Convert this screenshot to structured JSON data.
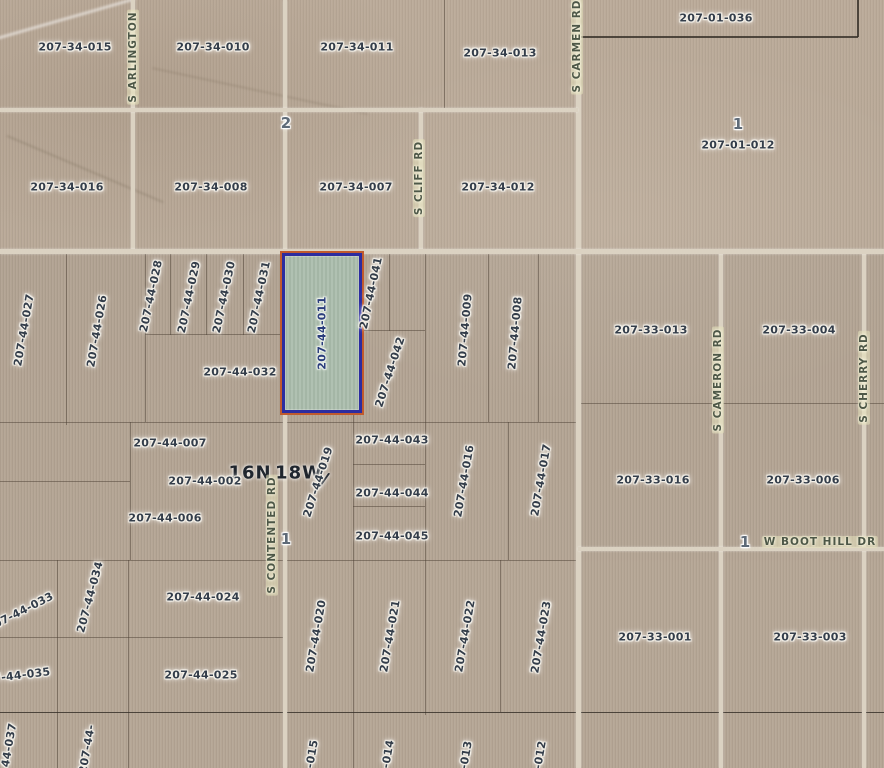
{
  "map": {
    "kind": "county-assessor-parcel-map",
    "colors": {
      "ground": "#b7a897",
      "road": "#dbd2c2",
      "parcel_line": "#4b4034",
      "label_text": "#333d4a",
      "highlight_border": "#2c2ca0",
      "highlight_outer": "#c05a2e",
      "highlight_fill": "#aabbac"
    },
    "highlight": {
      "x": 282,
      "y": 253,
      "w": 74,
      "h": 154,
      "label": "207-44-011"
    },
    "township_labels": [
      {
        "t": "16N",
        "x": 250,
        "y": 473
      },
      {
        "t": "18W",
        "x": 299,
        "y": 473
      },
      {
        "t": "/",
        "x": 325,
        "y": 480,
        "rot": 18
      }
    ],
    "section_markers": [
      {
        "t": "2",
        "x": 286,
        "y": 123
      },
      {
        "t": "1",
        "x": 738,
        "y": 124
      },
      {
        "t": "1",
        "x": 286,
        "y": 539
      },
      {
        "t": "1",
        "x": 745,
        "y": 542
      }
    ],
    "road_labels": [
      {
        "t": "S ARLINGTON",
        "x": 133,
        "y": 57,
        "rot": -90
      },
      {
        "t": "S CLIFF RD",
        "x": 419,
        "y": 178,
        "rot": -90
      },
      {
        "t": "S CARMEN RD",
        "x": 577,
        "y": 46,
        "rot": -90
      },
      {
        "t": "S CONTENTED RD",
        "x": 272,
        "y": 535,
        "rot": -90
      },
      {
        "t": "S CAMERON RD",
        "x": 718,
        "y": 380,
        "rot": -90
      },
      {
        "t": "S CHERRY RD",
        "x": 864,
        "y": 378,
        "rot": -90
      },
      {
        "t": "W BOOT HILL DR",
        "x": 820,
        "y": 542
      }
    ],
    "parcel_labels": [
      {
        "t": "207-34-015",
        "x": 75,
        "y": 47
      },
      {
        "t": "207-34-010",
        "x": 213,
        "y": 47
      },
      {
        "t": "207-34-011",
        "x": 357,
        "y": 47
      },
      {
        "t": "207-34-013",
        "x": 500,
        "y": 53
      },
      {
        "t": "207-01-036",
        "x": 716,
        "y": 18
      },
      {
        "t": "207-01-012",
        "x": 738,
        "y": 145
      },
      {
        "t": "207-34-016",
        "x": 67,
        "y": 187
      },
      {
        "t": "207-34-008",
        "x": 211,
        "y": 187
      },
      {
        "t": "207-34-007",
        "x": 356,
        "y": 187
      },
      {
        "t": "207-34-012",
        "x": 498,
        "y": 187
      },
      {
        "t": "207-44-027",
        "x": 24,
        "y": 330,
        "rot": -80
      },
      {
        "t": "207-44-026",
        "x": 97,
        "y": 331,
        "rot": -80
      },
      {
        "t": "207-44-028",
        "x": 151,
        "y": 296,
        "rot": -78
      },
      {
        "t": "207-44-029",
        "x": 189,
        "y": 297,
        "rot": -78
      },
      {
        "t": "207-44-030",
        "x": 224,
        "y": 297,
        "rot": -78
      },
      {
        "t": "207-44-031",
        "x": 259,
        "y": 297,
        "rot": -78
      },
      {
        "t": "207-44-041",
        "x": 371,
        "y": 293,
        "rot": -78
      },
      {
        "t": "207-44-042",
        "x": 390,
        "y": 372,
        "rot": -72
      },
      {
        "t": "207-44-032",
        "x": 240,
        "y": 372
      },
      {
        "t": "207-44-009",
        "x": 465,
        "y": 330,
        "rot": -85
      },
      {
        "t": "207-44-008",
        "x": 515,
        "y": 333,
        "rot": -85
      },
      {
        "t": "207-33-013",
        "x": 651,
        "y": 330
      },
      {
        "t": "207-33-004",
        "x": 799,
        "y": 330
      },
      {
        "t": "207-44-007",
        "x": 170,
        "y": 443
      },
      {
        "t": "207-44-002",
        "x": 205,
        "y": 481
      },
      {
        "t": "207-44-019",
        "x": 318,
        "y": 482,
        "rot": -72
      },
      {
        "t": "207-44-006",
        "x": 165,
        "y": 518
      },
      {
        "t": "207-44-043",
        "x": 392,
        "y": 440
      },
      {
        "t": "207-44-044",
        "x": 392,
        "y": 493
      },
      {
        "t": "207-44-045",
        "x": 392,
        "y": 536
      },
      {
        "t": "207-44-016",
        "x": 464,
        "y": 481,
        "rot": -80
      },
      {
        "t": "207-44-017",
        "x": 541,
        "y": 480,
        "rot": -80
      },
      {
        "t": "207-33-016",
        "x": 653,
        "y": 480
      },
      {
        "t": "207-33-006",
        "x": 803,
        "y": 480
      },
      {
        "t": "207-44-033",
        "x": 20,
        "y": 612,
        "rot": -27
      },
      {
        "t": "207-44-034",
        "x": 90,
        "y": 597,
        "rot": -75
      },
      {
        "t": "207-44-024",
        "x": 203,
        "y": 597
      },
      {
        "t": "207-44-035",
        "x": 14,
        "y": 676,
        "rot": -7
      },
      {
        "t": "207-44-025",
        "x": 201,
        "y": 675
      },
      {
        "t": "207-44-020",
        "x": 316,
        "y": 636,
        "rot": -80
      },
      {
        "t": "207-44-021",
        "x": 390,
        "y": 636,
        "rot": -80
      },
      {
        "t": "207-44-022",
        "x": 465,
        "y": 636,
        "rot": -80
      },
      {
        "t": "207-44-023",
        "x": 541,
        "y": 637,
        "rot": -80
      },
      {
        "t": "207-33-001",
        "x": 655,
        "y": 637
      },
      {
        "t": "207-33-003",
        "x": 810,
        "y": 637
      },
      {
        "t": "44-037",
        "x": 9,
        "y": 745,
        "rot": -80
      },
      {
        "t": "207-44-",
        "x": 87,
        "y": 749,
        "rot": -80
      },
      {
        "t": "-015",
        "x": 312,
        "y": 754,
        "rot": -80
      },
      {
        "t": "-014",
        "x": 388,
        "y": 754,
        "rot": -80
      },
      {
        "t": "-013",
        "x": 466,
        "y": 755,
        "rot": -80
      },
      {
        "t": "-012",
        "x": 540,
        "y": 755,
        "rot": -80
      }
    ],
    "roads": [
      {
        "x": 131,
        "y": 0,
        "w": 4,
        "h": 250
      },
      {
        "x": 283,
        "y": 0,
        "w": 4,
        "h": 768
      },
      {
        "x": 419,
        "y": 108,
        "w": 4,
        "h": 142
      },
      {
        "x": 576,
        "y": 0,
        "w": 5,
        "h": 768
      },
      {
        "x": 719,
        "y": 250,
        "w": 4,
        "h": 518
      },
      {
        "x": 862,
        "y": 250,
        "w": 4,
        "h": 518
      },
      {
        "x": 0,
        "y": 108,
        "w": 578,
        "h": 4
      },
      {
        "x": 0,
        "y": 249,
        "w": 884,
        "h": 5
      },
      {
        "x": 578,
        "y": 547,
        "w": 306,
        "h": 4
      }
    ],
    "boundary_lines": [
      {
        "x": 577,
        "y": 36,
        "w": 281,
        "h": 2,
        "strong": true
      },
      {
        "x": 857,
        "y": 0,
        "w": 2,
        "h": 37,
        "strong": true
      },
      {
        "x": 444,
        "y": 0,
        "w": 1,
        "h": 108
      },
      {
        "x": 66,
        "y": 250,
        "w": 1,
        "h": 175
      },
      {
        "x": 145,
        "y": 250,
        "w": 1,
        "h": 172
      },
      {
        "x": 170,
        "y": 253,
        "w": 1,
        "h": 82
      },
      {
        "x": 206,
        "y": 253,
        "w": 1,
        "h": 82
      },
      {
        "x": 243,
        "y": 253,
        "w": 1,
        "h": 82
      },
      {
        "x": 145,
        "y": 334,
        "w": 137,
        "h": 1
      },
      {
        "x": 389,
        "y": 253,
        "w": 1,
        "h": 78
      },
      {
        "x": 357,
        "y": 330,
        "w": 68,
        "h": 1
      },
      {
        "x": 425,
        "y": 250,
        "w": 1,
        "h": 465
      },
      {
        "x": 488,
        "y": 250,
        "w": 1,
        "h": 172
      },
      {
        "x": 538,
        "y": 250,
        "w": 1,
        "h": 172
      },
      {
        "x": 0,
        "y": 422,
        "w": 577,
        "h": 1
      },
      {
        "x": 130,
        "y": 422,
        "w": 1,
        "h": 138
      },
      {
        "x": 0,
        "y": 481,
        "w": 130,
        "h": 1
      },
      {
        "x": 353,
        "y": 464,
        "w": 72,
        "h": 1
      },
      {
        "x": 353,
        "y": 506,
        "w": 72,
        "h": 1
      },
      {
        "x": 353,
        "y": 407,
        "w": 1,
        "h": 361
      },
      {
        "x": 508,
        "y": 422,
        "w": 1,
        "h": 138
      },
      {
        "x": 0,
        "y": 560,
        "w": 578,
        "h": 1
      },
      {
        "x": 57,
        "y": 560,
        "w": 1,
        "h": 208
      },
      {
        "x": 128,
        "y": 560,
        "w": 1,
        "h": 208
      },
      {
        "x": 0,
        "y": 637,
        "w": 283,
        "h": 1
      },
      {
        "x": 500,
        "y": 560,
        "w": 1,
        "h": 152
      },
      {
        "x": 0,
        "y": 712,
        "w": 884,
        "h": 1,
        "strong": true
      },
      {
        "x": 578,
        "y": 403,
        "w": 306,
        "h": 1
      }
    ]
  }
}
